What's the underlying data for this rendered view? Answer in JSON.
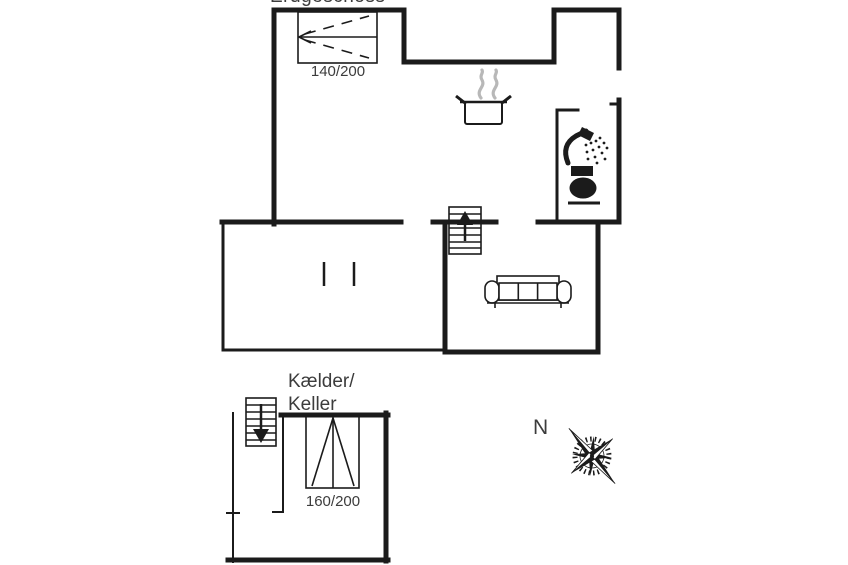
{
  "colors": {
    "background": "#ffffff",
    "line": "#1b1b1b",
    "text": "#3c3c3c",
    "steam": "#b8b8b8"
  },
  "floor_plan": {
    "ground_floor": {
      "title": "Erdgeschoss",
      "bed_size": "140/200"
    },
    "basement": {
      "label_line1": "Kælder/",
      "label_line2": "Keller",
      "bed_size": "160/200"
    },
    "compass": {
      "north_label": "N"
    },
    "icons": {
      "double_bed": "double-bed-icon",
      "cooking_pot": "cooking-pot-icon",
      "steam": "steam-icon",
      "shower": "shower-icon",
      "toilet": "toilet-icon",
      "stairs_up": "stairs-up-icon",
      "sofa": "sofa-icon",
      "stairs_down": "stairs-down-icon",
      "single_bed": "single-bed-icon",
      "compass_rose": "compass-rose-icon"
    }
  }
}
